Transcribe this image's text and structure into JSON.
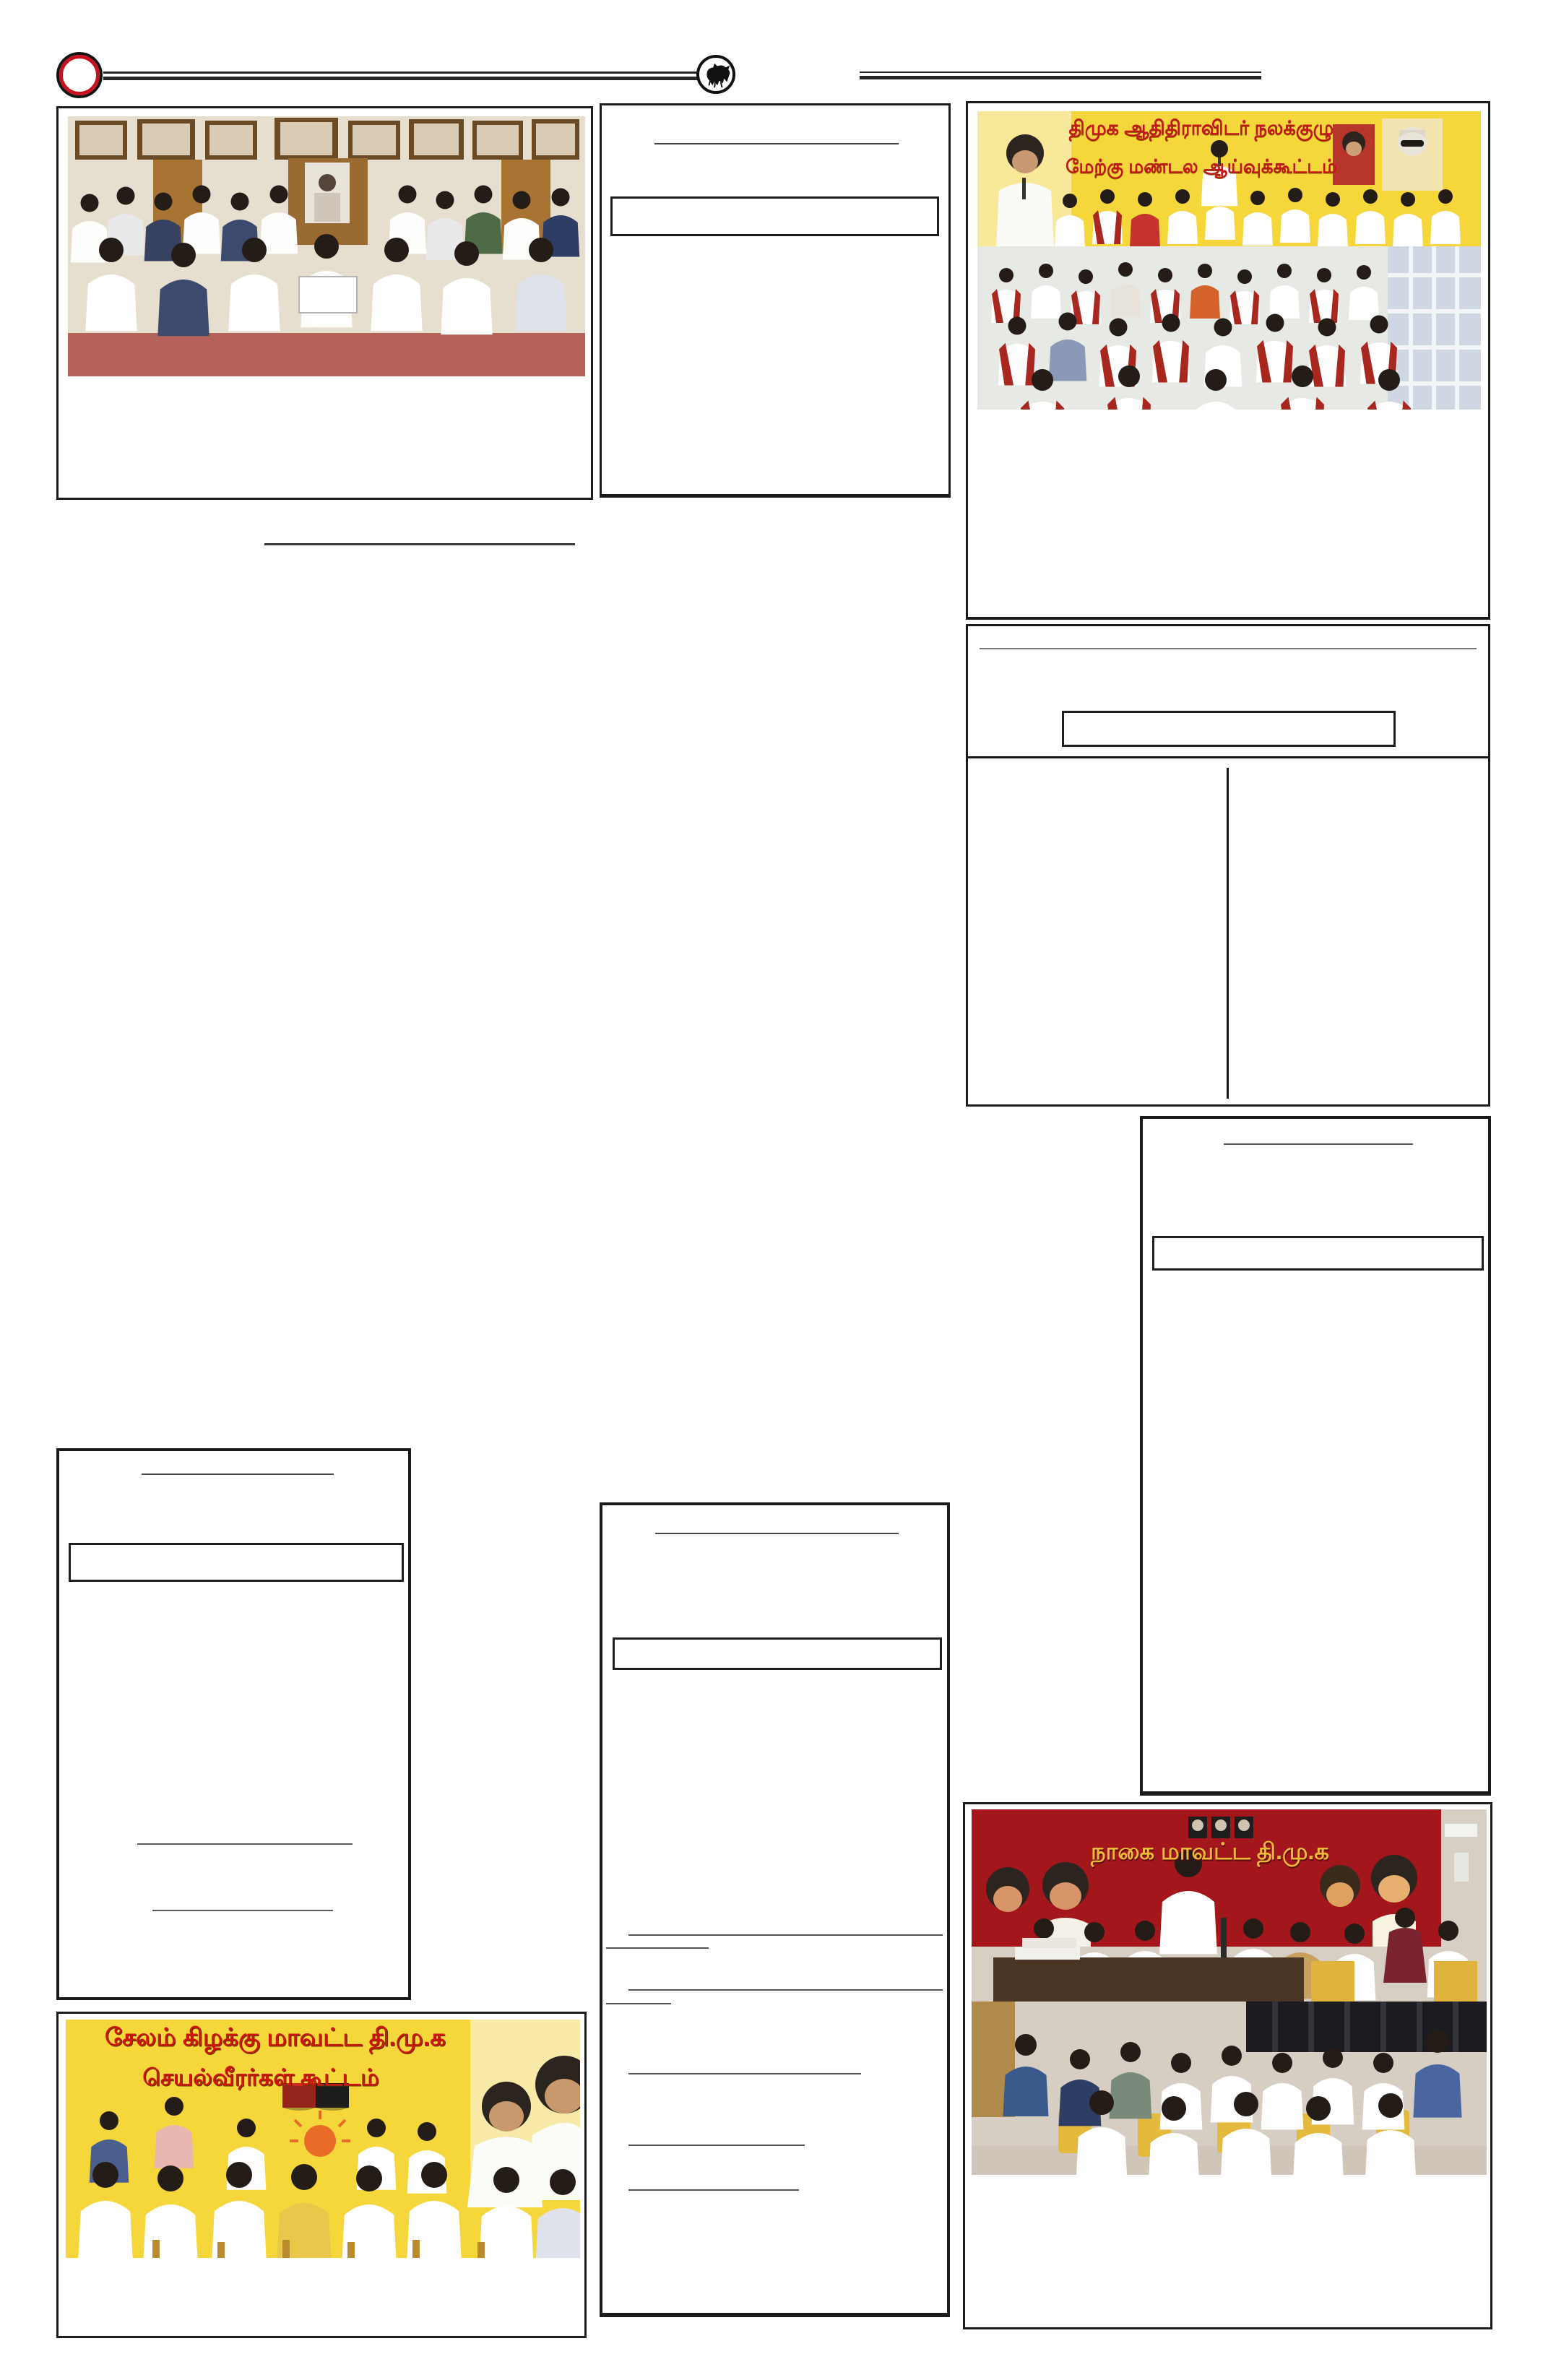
{
  "page": {
    "kind": "newspaper-page-scan",
    "background": "#ffffff"
  },
  "masthead": {
    "left_ornament_icon": "red-ring-icon",
    "emblem_icon": "bull-emblem-icon",
    "ring_red": "#c8101e",
    "rule_black": "#262626"
  },
  "colors": {
    "frame_black": "#1b1b1b",
    "banner_yellow": "#f5d73b",
    "banner_red": "#a3161c",
    "text_red": "#c5161d",
    "text_gold": "#eeb93a",
    "flag_red": "#d5281e",
    "flag_black": "#1d1d1b",
    "shawl_red": "#a8281f"
  },
  "photos": {
    "adidravidar_meeting": {
      "banner_line1": "திமுக ஆதிதிராவிடர் நலக்குழு",
      "banner_line2": "மேற்கு மண்டல ஆய்வுக்கூட்டம்"
    },
    "salem_east": {
      "banner_line1": "சேலம் கிழக்கு மாவட்ட தி.மு.க",
      "banner_line2": "செயல்வீரர்கள் கூட்டம்"
    },
    "nagai": {
      "banner_line1": "நாகை மாவட்ட தி.மு.க"
    }
  }
}
